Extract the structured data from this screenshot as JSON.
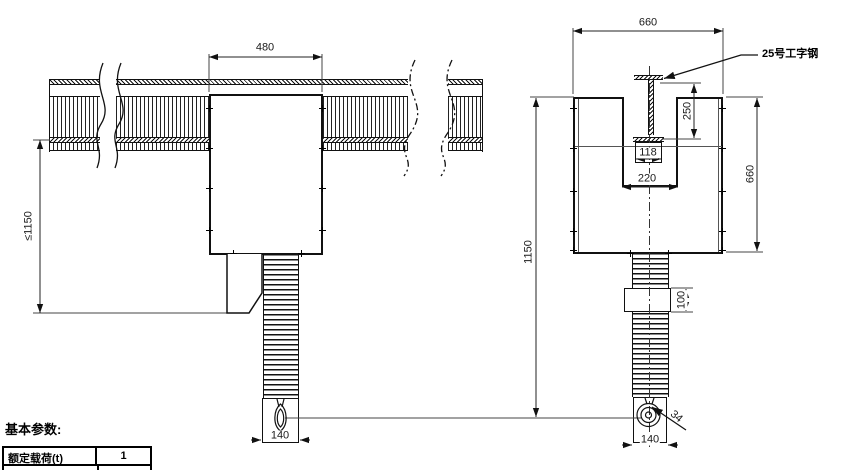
{
  "drawing": {
    "ink": "#111111",
    "dims": {
      "d480": "480",
      "d660_top": "660",
      "d250": "250",
      "d118": "118",
      "d220": "220",
      "d660_side": "660",
      "d1150": "1150",
      "dle1150": "≤1150",
      "d100": "100",
      "d34": "34",
      "d140_front": "140",
      "d140_side": "140"
    },
    "callouts": {
      "ibeam": "25号工字钢"
    },
    "params": {
      "title": "基本参数:",
      "rows": [
        {
          "label": "额定载荷(t)",
          "value": "1"
        }
      ]
    }
  }
}
